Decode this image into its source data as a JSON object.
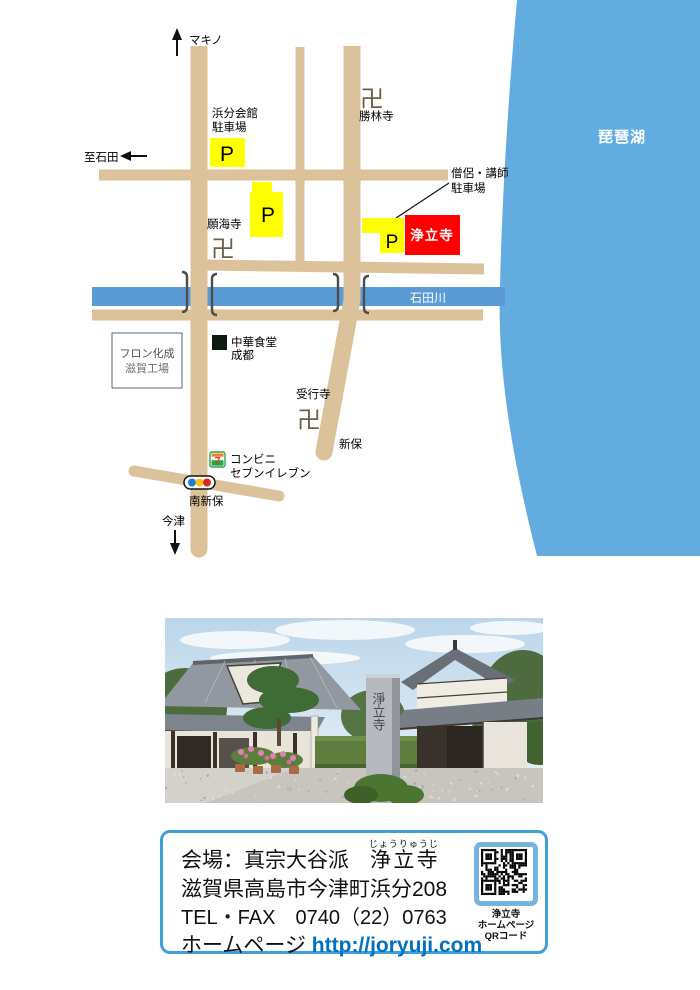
{
  "map": {
    "lake_label": "琵琶湖",
    "river_label": "石田川",
    "north_label": "マキノ",
    "west_label": "至石田",
    "south_label": "今津",
    "hall_parking_line1": "浜分会館",
    "hall_parking_line2": "駐車場",
    "monk_parking_line1": "僧侶・講師",
    "monk_parking_line2": "駐車場",
    "temple_shorinji": "勝林寺",
    "temple_gankaiji": "願海寺",
    "temple_jugyoji": "受行寺",
    "temple_mark": "卍",
    "parking_letter": "P",
    "destination_label": "浄立寺",
    "restaurant_line1": "中華食堂",
    "restaurant_line2": "成都",
    "factory_line1": "フロン化成",
    "factory_line2": "滋賀工場",
    "shinbo_label": "新保",
    "minami_shinbo_label": "南新保",
    "conbini_line1": "コンビニ",
    "conbini_line2": "セブンイレブン",
    "seven_logo_digit": "7",
    "colors": {
      "road": "#dbc29b",
      "river": "#5b9bd5",
      "lake": "#63ace0",
      "parking": "#ffff00",
      "destination": "#ff0000"
    }
  },
  "photo": {
    "monument_text": "淨立寺"
  },
  "info": {
    "line1_prefix": "会場：真宗大谷派　",
    "line1_temple": "浄立寺",
    "line1_furigana": "じょうりゅうじ",
    "line2": "滋賀県高島市今津町浜分208",
    "line3": "TEL・FAX　0740（22）0763",
    "line4_label": "ホームページ ",
    "line4_url": "http://joryuji.com",
    "qr_caption_1": "浄立寺",
    "qr_caption_2": "ホームページ",
    "qr_caption_3": "QRコード"
  }
}
